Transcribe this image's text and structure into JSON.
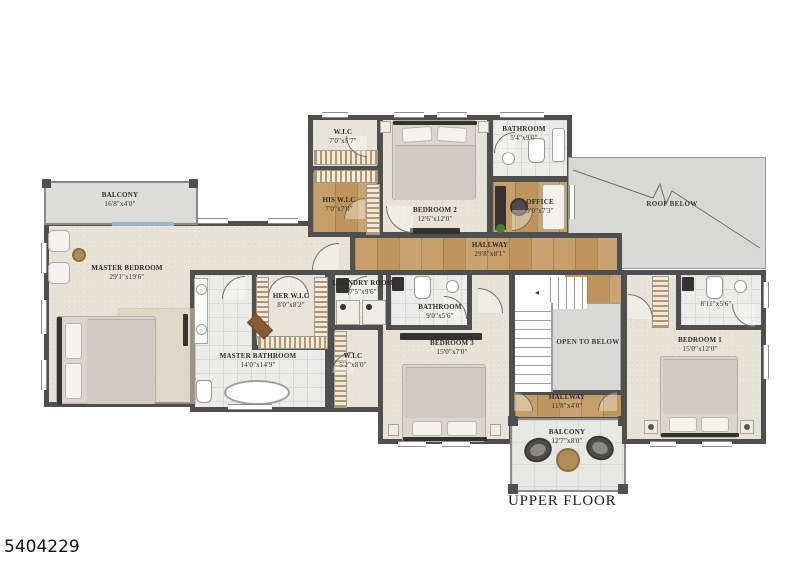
{
  "page": {
    "photo_id": "5404229",
    "title": "UPPER FLOOR"
  },
  "rooms": [
    {
      "name": "BALCONY",
      "dims": "16'8\"x4'0\""
    },
    {
      "name": "MASTER BEDROOM",
      "dims": "29'1\"x19'6\""
    },
    {
      "name": "W.I.C",
      "dims": "7'0\"x5'7\""
    },
    {
      "name": "HIS W.I.C",
      "dims": "7'0\"x7'0\""
    },
    {
      "name": "BEDROOM 2",
      "dims": "12'6\"x12'0\""
    },
    {
      "name": "BATHROOM",
      "dims": "5'4\"x9'0\""
    },
    {
      "name": "OFFICE",
      "dims": "9'0\"x7'3\""
    },
    {
      "name": "ROOF BELOW",
      "dims": ""
    },
    {
      "name": "HALLWAY",
      "dims": "29'8\"x8'1\""
    },
    {
      "name": "HER W.I.C",
      "dims": "8'0\"x8'2\""
    },
    {
      "name": "MASTER BATHROOM",
      "dims": "14'0\"x14'9\""
    },
    {
      "name": "LAUNDRY ROOM",
      "dims": "7'5\"x9'6\""
    },
    {
      "name": "W.I.C",
      "dims": "5'2\"x8'0\""
    },
    {
      "name": "BATHROOM",
      "dims": "9'0\"x5'6\""
    },
    {
      "name": "BEDROOM 3",
      "dims": "15'0\"x7'0\""
    },
    {
      "name": "",
      "dims": "8'11\"x5'6\""
    },
    {
      "name": "BEDROOM 1",
      "dims": "15'0\"x12'0\""
    },
    {
      "name": "OPEN TO BELOW",
      "dims": ""
    },
    {
      "name": "HALLWAY",
      "dims": "11'8\"x4'0\""
    },
    {
      "name": "BALCONY",
      "dims": "12'7\"x8'0\""
    }
  ]
}
